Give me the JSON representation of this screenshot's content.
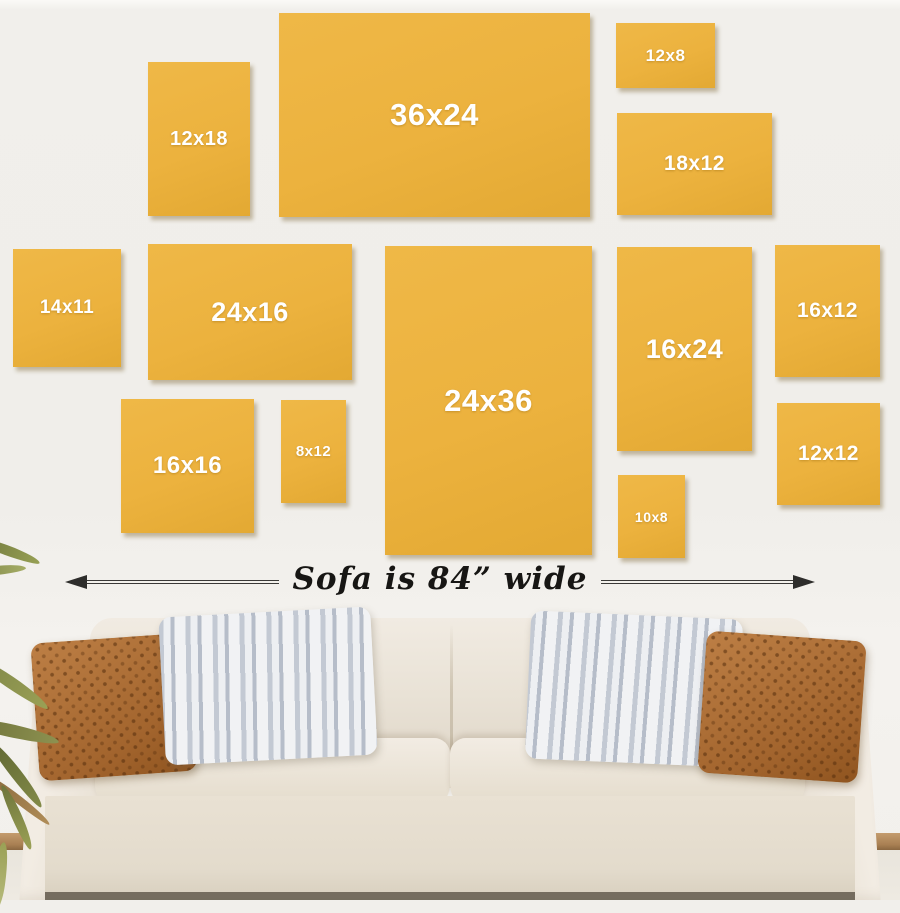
{
  "collage": {
    "canvases": [
      {
        "label": "12x18",
        "x": 148,
        "y": 62,
        "w": 102,
        "h": 154,
        "fs": 20
      },
      {
        "label": "36x24",
        "x": 279,
        "y": 13,
        "w": 311,
        "h": 204,
        "fs": 31
      },
      {
        "label": "12x8",
        "x": 616,
        "y": 23,
        "w": 99,
        "h": 65,
        "fs": 17
      },
      {
        "label": "18x12",
        "x": 617,
        "y": 113,
        "w": 155,
        "h": 102,
        "fs": 21
      },
      {
        "label": "14x11",
        "x": 13,
        "y": 249,
        "w": 108,
        "h": 118,
        "fs": 19
      },
      {
        "label": "24x16",
        "x": 148,
        "y": 244,
        "w": 204,
        "h": 136,
        "fs": 27
      },
      {
        "label": "24x36",
        "x": 385,
        "y": 246,
        "w": 207,
        "h": 309,
        "fs": 31
      },
      {
        "label": "16x24",
        "x": 617,
        "y": 247,
        "w": 135,
        "h": 204,
        "fs": 27
      },
      {
        "label": "16x12",
        "x": 775,
        "y": 245,
        "w": 105,
        "h": 132,
        "fs": 21
      },
      {
        "label": "16x16",
        "x": 121,
        "y": 399,
        "w": 133,
        "h": 134,
        "fs": 24
      },
      {
        "label": "8x12",
        "x": 281,
        "y": 400,
        "w": 65,
        "h": 103,
        "fs": 15
      },
      {
        "label": "10x8",
        "x": 618,
        "y": 475,
        "w": 67,
        "h": 83,
        "fs": 14
      },
      {
        "label": "12x12",
        "x": 777,
        "y": 403,
        "w": 103,
        "h": 102,
        "fs": 21
      }
    ],
    "colors": {
      "canvas_gold": "#ecb23e",
      "label_white": "#ffffff",
      "wall": "#f0eeea",
      "arrow": "#2e2d2b"
    }
  },
  "dimension": {
    "label": "Sofa is 84” wide"
  }
}
